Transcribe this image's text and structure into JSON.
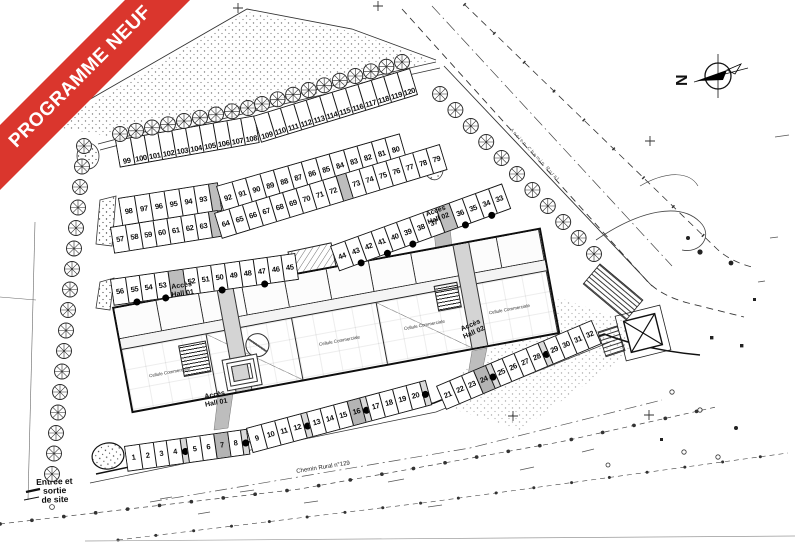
{
  "banner": {
    "label": "PROGRAMME NEUF",
    "color": "#da362d"
  },
  "compass": {
    "north": "N"
  },
  "labels": {
    "hall1": [
      "Accès",
      "Hall 01"
    ],
    "hall2": [
      "Accès",
      "Hall 02"
    ],
    "entrance": [
      "Entrée et",
      "sortie",
      "de site"
    ],
    "road_bottom": "Chemin Rural n°129",
    "road_top": "Ancien Chemin Rural",
    "room": "Cellule Commerciale"
  },
  "rows": {
    "top": [
      99,
      100,
      101,
      102,
      103,
      104,
      105,
      106,
      107,
      108,
      109,
      110,
      111,
      112,
      113,
      114,
      115,
      116,
      117,
      118,
      119,
      120
    ],
    "second_upper": [
      98,
      97,
      96,
      95,
      94,
      93,
      92,
      91,
      90,
      89,
      88,
      87,
      86,
      85,
      84,
      83,
      82,
      81,
      80
    ],
    "second_lower": [
      57,
      58,
      59,
      60,
      61,
      62,
      63,
      64,
      65,
      66,
      67,
      68,
      69,
      70,
      71,
      72,
      73,
      74,
      75,
      76,
      77,
      78,
      79
    ],
    "third_left": [
      56,
      55,
      54,
      53,
      52,
      51,
      50,
      49,
      48,
      47,
      46,
      45
    ],
    "third_right": [
      44,
      43,
      42,
      41,
      40,
      39,
      38,
      37,
      36,
      35,
      34,
      33
    ],
    "bottom_a": [
      1,
      2,
      3,
      4,
      5,
      6,
      7,
      8
    ],
    "bottom_b": [
      9,
      10,
      11,
      12,
      13,
      14,
      15,
      16,
      17,
      18,
      19,
      20
    ],
    "bottom_c": [
      21,
      22,
      23,
      24,
      25,
      26,
      27,
      28,
      29,
      30,
      31,
      32
    ],
    "gray_units": [
      7,
      16,
      24
    ]
  }
}
